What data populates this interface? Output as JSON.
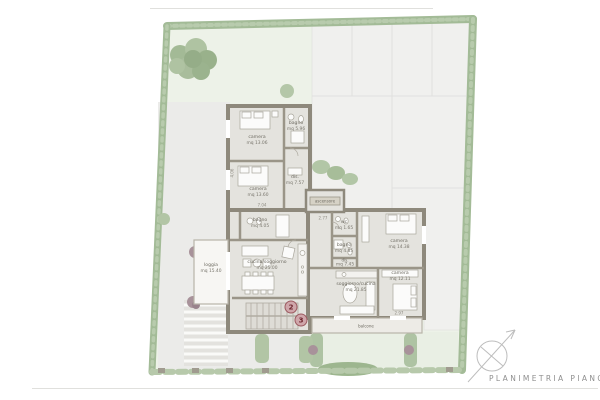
{
  "page": {
    "title": "PLANIMETRIA PIANO PRIMO"
  },
  "plan": {
    "rooms": {
      "camera_nw": {
        "label": "camera",
        "area": "mq 13.06"
      },
      "bagno_nw": {
        "label": "bagno",
        "area": "mq 5.96"
      },
      "camera_w": {
        "label": "camera",
        "area": "mq 13.60"
      },
      "dis_nw": {
        "label": "dis.",
        "area": "mq 7.57"
      },
      "ascensore": {
        "label": "ascensore"
      },
      "bagno_unit2": {
        "label": "bagno",
        "area": "mq 4.05"
      },
      "living_unit2": {
        "label": "cucina/soggiorno",
        "area": "mq 25.00"
      },
      "loggia": {
        "label": "loggia",
        "area": "mq 15.40"
      },
      "wc": {
        "label": "wc",
        "area": "mq 1.65"
      },
      "bagno_unit3": {
        "label": "bagno",
        "area": "mq 4.85"
      },
      "dis_unit3": {
        "label": "dis.",
        "area": "mq 7.45"
      },
      "camera_ne": {
        "label": "camera",
        "area": "mq 14.38"
      },
      "camera_e": {
        "label": "camera",
        "area": "mq 12.11"
      },
      "living_unit3": {
        "label": "soggiorno/cucina",
        "area": "mq 21.85"
      },
      "balcone": {
        "label": "balcone"
      }
    },
    "unit_markers": [
      {
        "number": "2"
      },
      {
        "number": "3"
      }
    ],
    "dimensions": [
      {
        "value": "7.04"
      },
      {
        "value": "2.77"
      },
      {
        "value": "2.97"
      },
      {
        "value": "4.06"
      }
    ],
    "icons": {
      "north_arrow": "compass-north-arrow"
    },
    "colors": {
      "hedge": "#a3bb97",
      "lawn": "#edf2e8",
      "paving": "#f0f0ee",
      "wall": "#8e897c",
      "floor": "#e4e3de",
      "unit_badge": "#9c5a60",
      "title_text": "#8f8f8f"
    }
  }
}
